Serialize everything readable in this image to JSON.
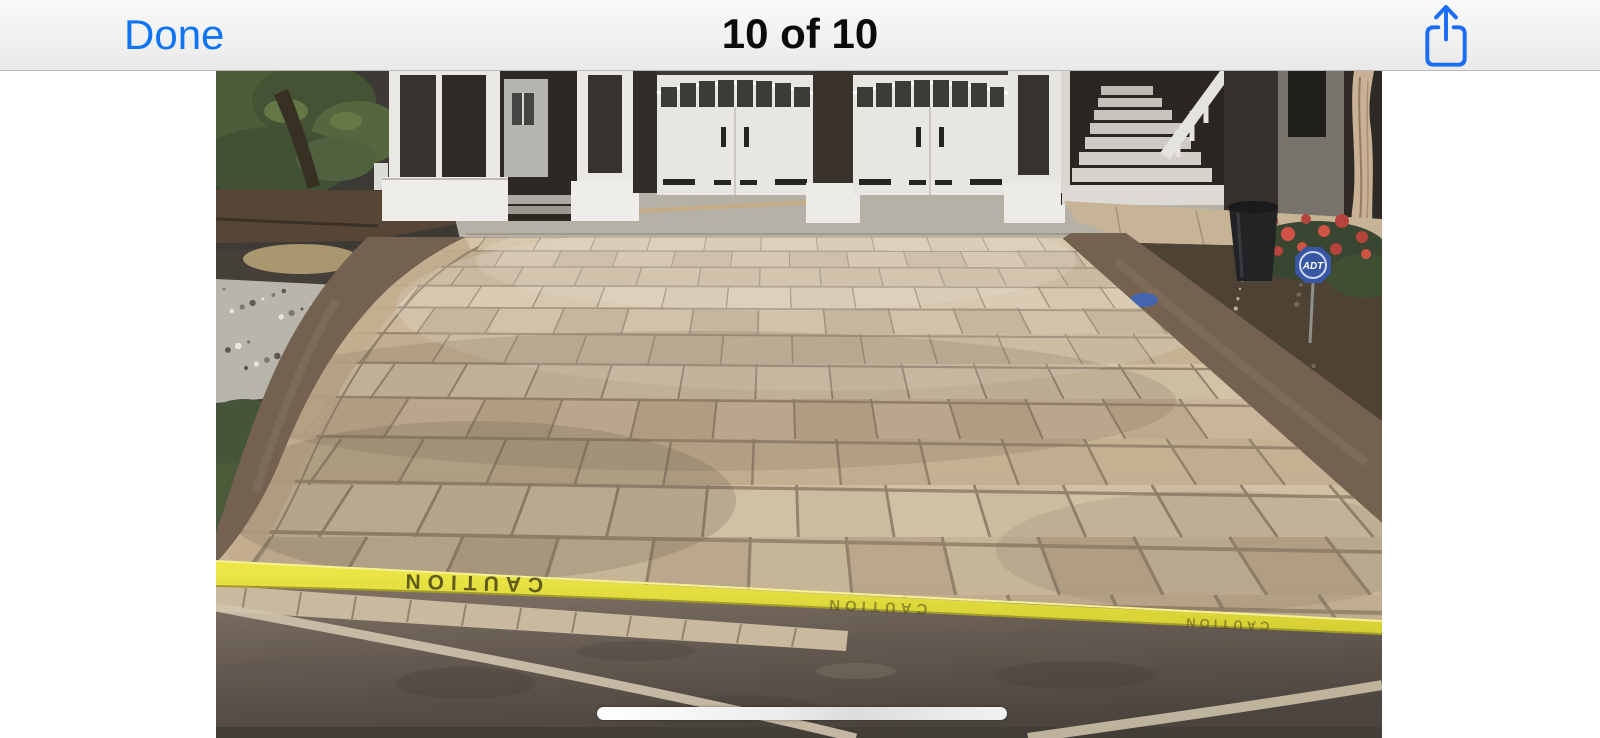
{
  "navbar": {
    "done_label": "Done",
    "title": "10 of 10",
    "share_icon": "share-icon"
  },
  "photo": {
    "description": "Stamped concrete driveway in tan ashlar slate pattern with dark stained border, in front of a house with two white carriage garage doors, side stairs, landscaping and yellow caution tape across the fresh concrete",
    "caution_tape_text": "CAUTION",
    "adt_sign_label": "ADT"
  },
  "colors": {
    "accent_blue": "#0f74f2",
    "nav_background": "#f0f0f0",
    "tape_yellow": "#e4de35",
    "driveway_tan": "#c7b396",
    "border_brown": "#6d5947"
  }
}
